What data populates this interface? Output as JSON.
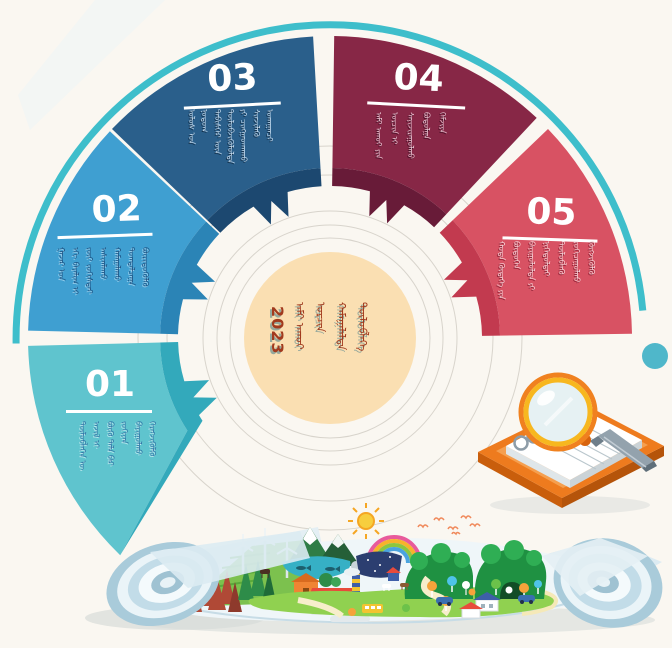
{
  "page": {
    "background_color": "#FAF7F1",
    "description": "2023 planning infographic wheel with five numbered sectors, Mongolian vertical script text, notebook with magnifier illustration and landscape blueprint illustration"
  },
  "wheel": {
    "decor": {
      "arc_color": "#3EBECB",
      "dot_color": "#4FB7CA",
      "ring_line_color": "#D8D4CC"
    },
    "center": {
      "year": "2023",
      "circle_color": "#FADFB2",
      "text_color": "#A13A1E",
      "shadow_color": "#95A89C",
      "text_mn": [
        "ᠠᠮᠢ ᠠᠬᠤᠢ",
        "ᠣᠷᠴᠢᠨ",
        "ᠬᠠᠮᠠᠭᠠᠯᠠᠯᠲᠠ",
        "ᠲᠥᠯᠥᠪᠯᠡᠭᠡ"
      ]
    },
    "segments": [
      {
        "number": "01",
        "color": "#5FC4CE",
        "band_color": "#33A9BB",
        "text_color": "#2D6FA3",
        "text_shadow": "#C8ECF0",
        "text_mn": [
          "ᠲᠥᠯᠥᠪᠯᠡᠭᠡᠨ ᠦ",
          "ᠠᠵᠢᠯ ᠢ",
          "ᠪᠦᠬᠦ ᠲᠠᠯᠠ ᠪᠠᠷ",
          "ᠵᠣᠬᠢᠶᠠᠨ",
          "ᠪᠠᠶᠢᠭᠤᠯᠬᠤ",
          "ᠬᠡᠷᠡᠭᠵᠢᠭᠦᠯᠬᠦ"
        ]
      },
      {
        "number": "02",
        "color": "#3F9FD1",
        "band_color": "#2B84B6",
        "text_color": "#1B4E7E",
        "text_shadow": "#A9D6EF",
        "text_mn": [
          "ᠭᠠᠵᠠᠷ ᠤᠨ",
          "ᠡᠬᠢ ᠪᠠᠶᠠᠯᠢᠭ ᠢ",
          "ᠵᠦᠢ ᠵᠣᠬᠢᠰᠲᠠᠢ",
          "ᠠᠰᠢᠭᠯᠠᠬᠤ",
          "ᠬᠠᠮᠠᠭᠠᠯᠠᠬᠤ",
          "ᠲᠣᠭᠲᠠᠯᠴᠠᠭᠠ",
          "ᠪᠦᠷᠢᠳᠦᠭᠦᠯᠬᠦ"
        ]
      },
      {
        "number": "03",
        "color": "#2A5F8B",
        "band_color": "#1C4870",
        "text_color": "#C9DFF2",
        "text_shadow": "#122C44",
        "text_mn": [
          "ᠤᠯᠤᠰ ᠤᠨ",
          "ᠨᠤᠲᠤᠭ",
          "ᠳᠡᠪᠢᠰᠬᠡᠷ ᠦᠨ",
          "ᠲᠥᠯᠥᠪᠵᠢᠭᠦᠯᠦᠯᠲᠡ",
          "ᠶᠢ ᠴᠢᠩᠭᠠᠳᠬᠠᠬᠤ",
          "ᠰᠢᠨᠵᠢᠯᠡᠬᠦ",
          "ᠤᠬᠠᠭᠠᠨᠴᠢ"
        ]
      },
      {
        "number": "04",
        "color": "#872746",
        "band_color": "#681B38",
        "text_color": "#ECC8D6",
        "text_shadow": "#3F0E22",
        "text_mn": [
          "ᠠᠮᠢ ᠠᠬᠤᠢ ᠶᠢᠨ",
          "ᠣᠷᠴᠢᠨ ᠢ",
          "ᠰᠠᠶᠢᠵᠢᠷᠠᠭᠤᠯᠬᠤ",
          "ᠪᠣᠳᠣᠯᠭᠠ",
          "ᠬᠡᠮᠵᠢᠶᠡ"
        ]
      },
      {
        "number": "05",
        "color": "#D85263",
        "band_color": "#C23A4F",
        "text_color": "#F8D7DB",
        "text_shadow": "#7E1B2E",
        "text_mn": [
          "ᠬᠣᠲᠠ ᠬᠥᠳᠡᠭᠡ ᠶᠢᠨ",
          "ᠪᠦᠲᠦᠭᠡᠨ",
          "ᠪᠠᠶᠢᠭᠤᠯᠤᠯᠲᠠ ᠶᠢ",
          "ᠨᠢᠭᠡᠳᠦᠯᠲᠡᠢ",
          "ᠲᠥᠯᠥᠪᠯᠡᠬᠦ",
          "ᠵᠣᠬᠢᠴᠠᠭᠤᠯᠬᠤ",
          "ᠬᠥᠭᠵᠢᠭᠦᠯᠬᠦ"
        ]
      }
    ]
  },
  "illustrations": {
    "notebook": {
      "board_color": "#EE7B1E",
      "page_color": "#FFFFFF",
      "magnifier_rim_color": "#F5B31E",
      "magnifier_glass_color": "#E6F1F3",
      "pen_color": "#93A2AD",
      "ring_color": "#8E9DA8"
    },
    "landscape": {
      "paper_color": "#EDF5F8",
      "roll_color": "#C2DCE8",
      "meadow_color": "#90D150",
      "hill_color": "#1F9142",
      "pond_color": "#36B0C5",
      "sun_color": "#F7CE3E",
      "rainbow_colors": [
        "#E85A9B",
        "#F7B32B",
        "#8DC63F",
        "#4AA3DF"
      ],
      "pine_red": "#B04936",
      "pine_green": "#2E8C49",
      "roof_red": "#E84B3C",
      "bird_color": "#F08A5C"
    }
  }
}
